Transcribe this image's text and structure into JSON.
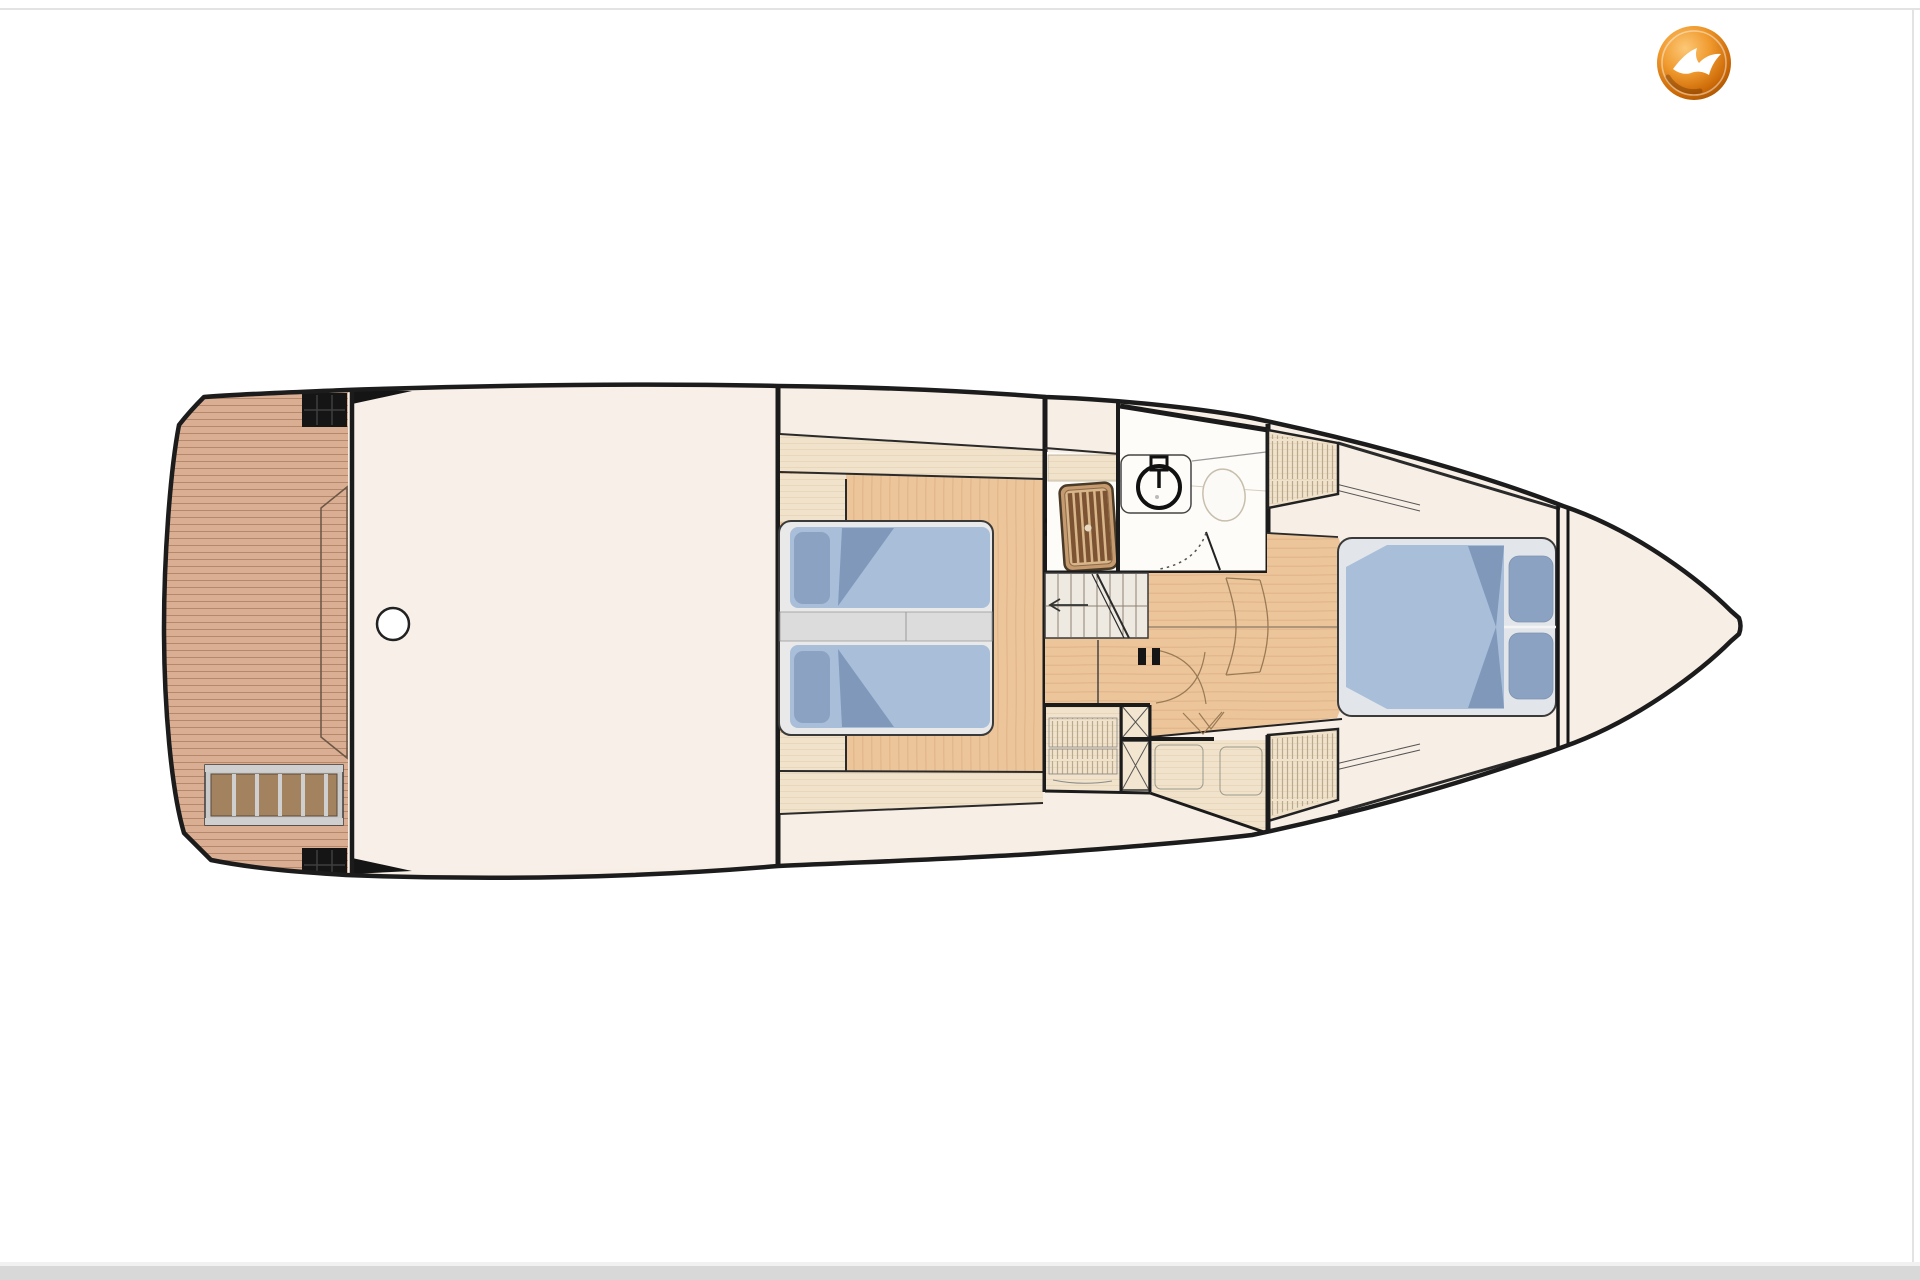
{
  "page": {
    "background": "#ffffff",
    "border_color": "#e3e3e3",
    "bottom_bar_color": "#d8d8d8"
  },
  "logo": {
    "name": "broker-logo-orange-sphere-white-bird",
    "cx": 1694,
    "cy": 63,
    "r": 37,
    "colors": {
      "highlight": "#fcc877",
      "mid": "#f09a2e",
      "deep": "#c96604",
      "rim": "#8f4a06",
      "bird": "#ffffff"
    }
  },
  "floorplan": {
    "type": "yacht-lower-deck-plan",
    "orientation": "bow-right",
    "colors": {
      "outline": "#1c1c1c",
      "wall": "#1b1b1b",
      "hull_fill": "#f7eee5",
      "deck_fill": "#f8f0e8",
      "teak": "#d9ae93",
      "teak_line": "#b5886c",
      "pale_wood": "#f0e2cb",
      "pale_wood_line": "#dfcba6",
      "floor_wood": "#ecc59b",
      "floor_wood_line": "#d9a97c",
      "bed_frame": "#e9e9e9",
      "bed_gap": "#dcdcdc",
      "mattress": "#a9bed9",
      "mattress_edge": "#7b90ad",
      "pillow": "#8ba2c2",
      "duvet": "#8099bb",
      "stairs_fill": "#efeae1",
      "stairs_line": "#8d8273",
      "bath_fill": "#fdfcf9",
      "grate_frame": "#c59a6e",
      "grate_slat": "#7c5434",
      "grate_gap": "#d9b58a",
      "ladder_frame": "#c9c9c9",
      "ladder_rail": "#cfcfcf",
      "ladder_slat": "#a3835f",
      "hatch_line": "#b9a98f",
      "detail_line": "#9a7a55",
      "fitting_black": "#151515"
    }
  }
}
